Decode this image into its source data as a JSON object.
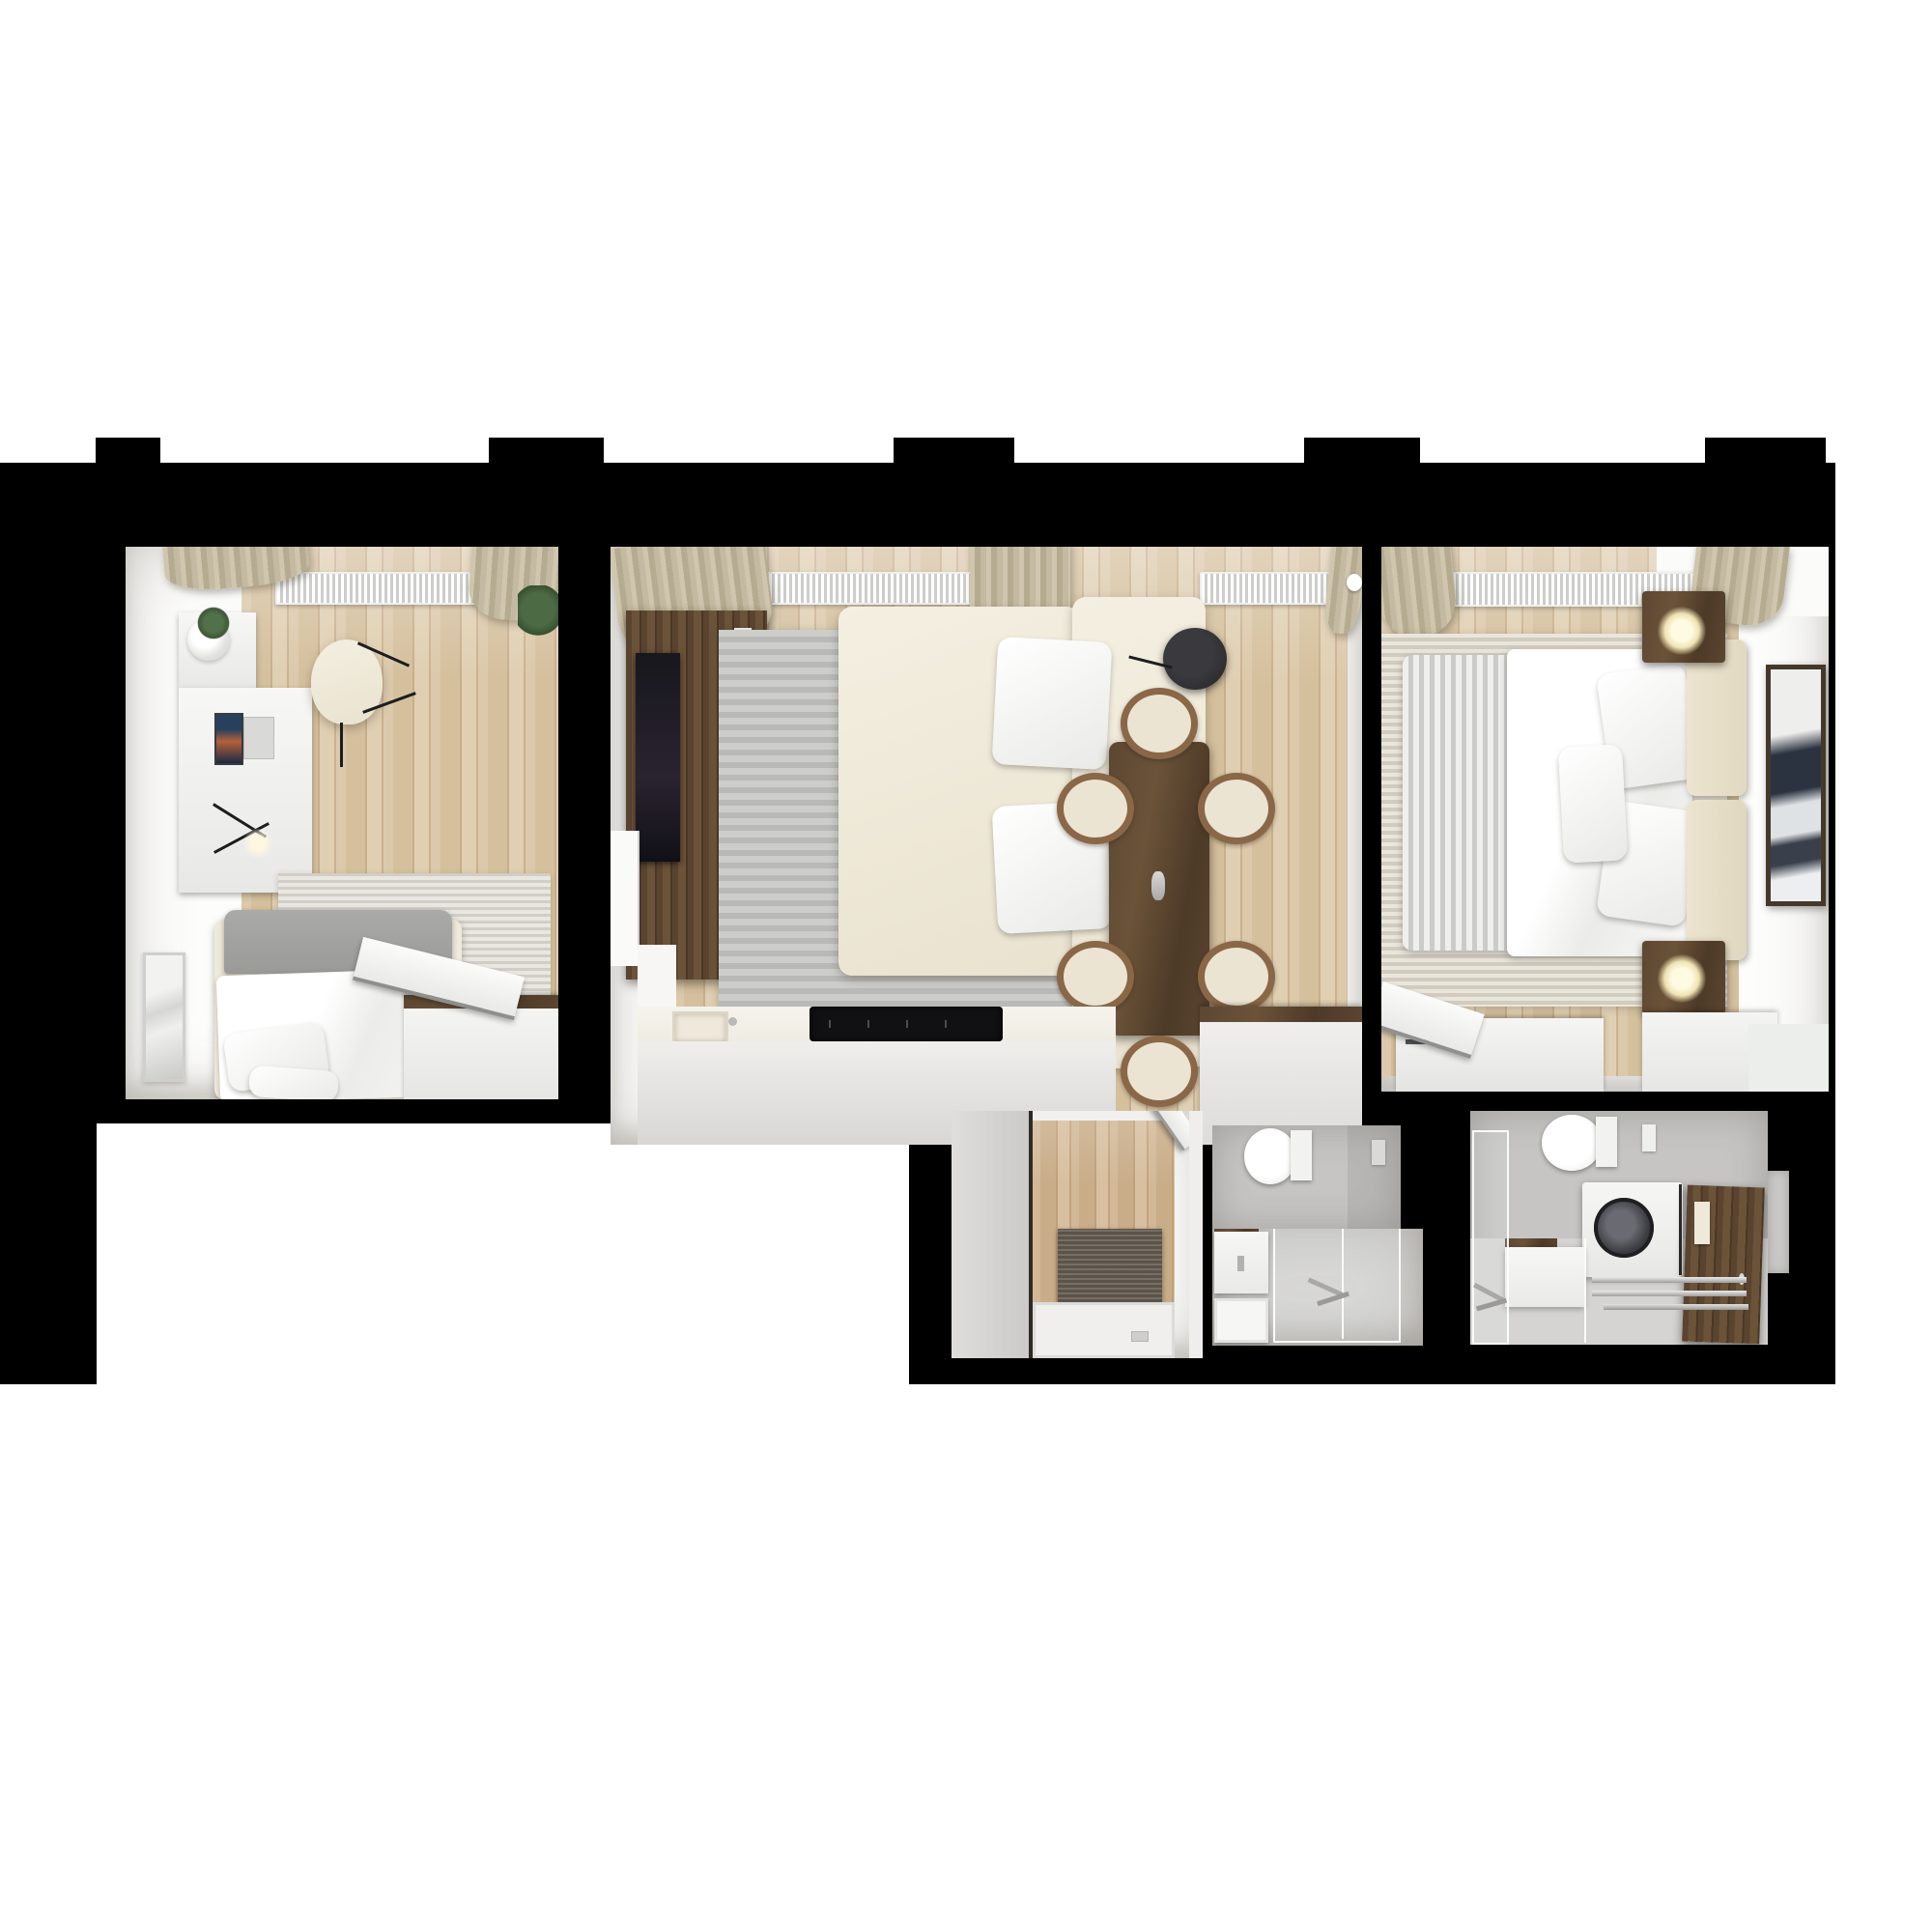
{
  "scene": {
    "kind": "3d-floor-plan-render-top-view",
    "canvas_background": "#ffffff",
    "plan_background": "#000000",
    "window_openings_in_top_wall": 5
  },
  "palette": {
    "wood_floor": "#d5c09e",
    "wood_floor_hall": "#c9ad89",
    "walnut_furniture": "#5d4732",
    "cream_upholstery": "#efe9da",
    "duvet_white": "#f7f7f5",
    "headboard_gray": "#a3a3a1",
    "rug_gray": "#c3c3c1",
    "rug_light": "#e0ddd6",
    "curtain_beige": "#c3b99f",
    "radiator_white": "#ffffff",
    "bathroom_tile": "#c6c5c3",
    "bathroom_floor": "#d5d4d2",
    "cooktop_black": "#111111",
    "doormat_gray": "#6b6258"
  },
  "rooms": [
    {
      "id": "bedroom-office",
      "position": "top-left",
      "items": [
        "desk",
        "laptop",
        "desk-lamp",
        "wall-shelf",
        "potted-plant",
        "office-chair",
        "single-bed",
        "gray-headboard",
        "pillows",
        "rug",
        "wall-mirror",
        "wardrobe",
        "open-door",
        "radiator",
        "curtains",
        "window-wall"
      ]
    },
    {
      "id": "living-room-kitchen",
      "position": "top-center",
      "items": [
        "tv-wall-panel",
        "tv-screen",
        "media-shelf",
        "poster-cards",
        "striped-rug",
        "corner-sofa",
        "back-cushions",
        "floor-lamp",
        "dining-table",
        "dining-chairs",
        "kitchen-counter",
        "kitchen-sink",
        "induction-cooktop",
        "kitchen-island",
        "radiators",
        "curtains",
        "wall-clock",
        "side-door"
      ],
      "dining_chairs_count": 6,
      "radiators_count": 2
    },
    {
      "id": "bedroom-master",
      "position": "top-right",
      "items": [
        "double-bed",
        "white-duvet",
        "striped-runner",
        "pillows",
        "cream-headboard",
        "nightstands",
        "glowing-table-lamps",
        "rug",
        "wall-art-frame",
        "bench",
        "dressers",
        "open-door",
        "radiator",
        "curtains"
      ],
      "nightstands_count": 2,
      "pillows_count": 3
    },
    {
      "id": "entry-hall",
      "position": "bottom-center-left",
      "items": [
        "tall-gray-cabinet",
        "wood-floor",
        "doormat",
        "open-white-door",
        "threshold-tray"
      ]
    },
    {
      "id": "bathroom-1",
      "position": "bottom-center",
      "items": [
        "toilet",
        "flush-plate",
        "vanity-with-sink",
        "second-basin",
        "glass-shower-enclosure",
        "shower-mixer"
      ]
    },
    {
      "id": "bathroom-2",
      "position": "bottom-right",
      "items": [
        "toilet",
        "flush-plate",
        "washing-machine",
        "walnut-door",
        "towel",
        "vanity-sink",
        "glass-shower-panel",
        "shower-mixer",
        "linear-drain-rails",
        "side-step"
      ]
    }
  ]
}
